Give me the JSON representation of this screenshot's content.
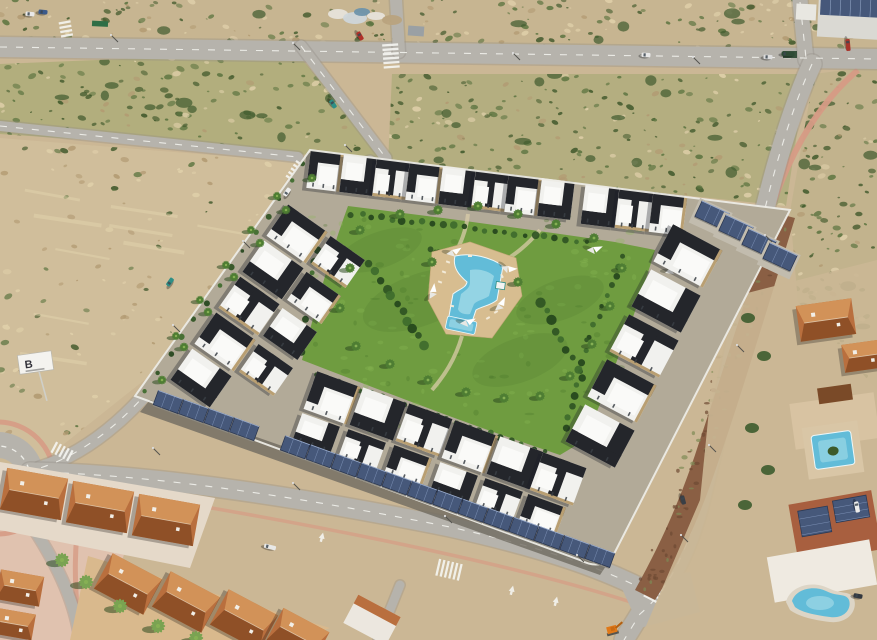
{
  "scene": {
    "type": "aerial-photograph",
    "description": "Aerial drone view of a modern white-and-black apartment complex with a central lawn, free-form swimming pool, palm trees and solar-panel carports, surrounded by new roads, sandy scrubland, a Spanish-style terracotta-roof neighborhood and villas with private pools."
  },
  "billboard": {
    "label": "B"
  },
  "colors": {
    "sand": "#cbb795",
    "sandLight": "#dccdab",
    "scrubGreen": "#7e9355",
    "scrubDark": "#55703c",
    "road": "#b6b3ac",
    "roadDark": "#a19e96",
    "marking": "#f4f4f0",
    "lawn": "#6f9c40",
    "lawnLight": "#8cbb57",
    "lawnDark": "#49742c",
    "poolWater": "#62bcd8",
    "poolLight": "#aadeea",
    "deck": "#d7bd90",
    "building": "#f1f1ee",
    "buildingShade": "#c6c9cd",
    "roofDark": "#24262b",
    "stone": "#b99f72",
    "solar": "#46587a",
    "solarDark": "#2c3a55",
    "terracotta": "#b96f3e",
    "terracottaLight": "#d29258",
    "terracottaDark": "#8f5027",
    "sidewalk": "#d69b85",
    "dirt": "#8a5f44",
    "wall": "#ecebe5",
    "hedge": "#2f5423",
    "palm": "#4e7d33",
    "palmShadow": "#2c4a1f"
  }
}
